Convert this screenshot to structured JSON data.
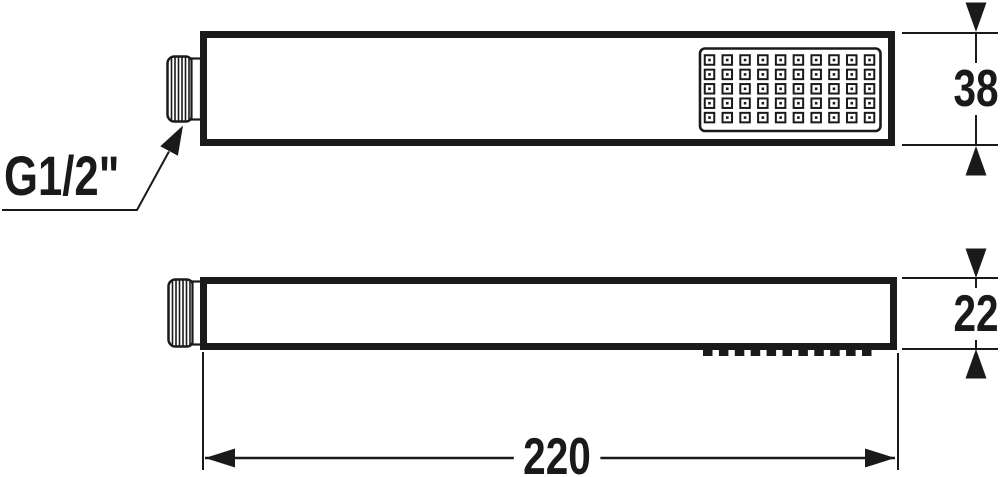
{
  "labels": {
    "thread": "G1/2\"",
    "height_top_view": "38",
    "height_side_view": "22",
    "length": "220"
  },
  "spray_face": {
    "rows": 5,
    "cols": 10
  },
  "nozzles": {
    "teeth": 11
  },
  "colors": {
    "line": "#1a1a1a",
    "background": "#ffffff"
  }
}
